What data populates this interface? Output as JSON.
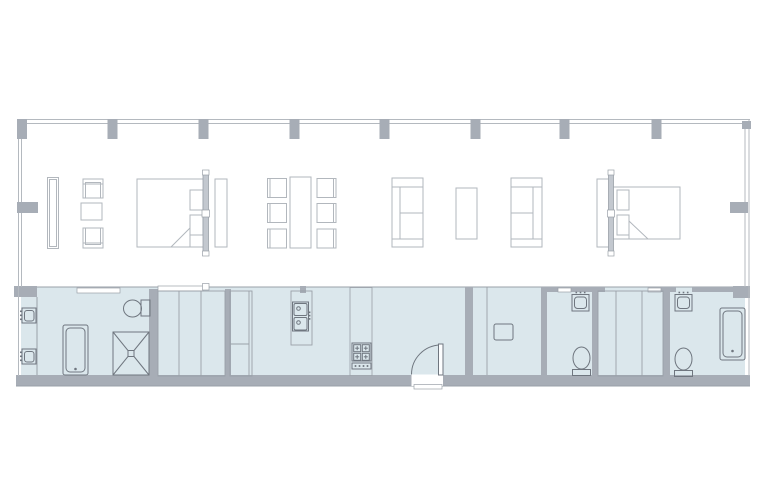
{
  "document": {
    "type": "architectural-floor-plan",
    "orientation": "landscape",
    "text_labels": []
  },
  "colors": {
    "background": "#ffffff",
    "wall_fill": "#a7adb6",
    "wall_line": "#9aa0a8",
    "outline_light": "#b4b9bf",
    "floor_fill": "#dbe7ec",
    "furniture_line": "#b2b7bd",
    "fixture_line": "#6f767f",
    "partition_fill": "#c3c8cf"
  },
  "inventory": {
    "structural_columns": 8,
    "wall_ticks": 4,
    "beds": 2,
    "bed_headboard_partitions": 2,
    "wardrobes": 2,
    "console_shelf": 1,
    "armchairs": 2,
    "side_tables": 3,
    "dining_tables": 1,
    "dining_chairs": 6,
    "sofas": 2,
    "coffee_tables": 1,
    "bathrooms": 3,
    "toilets": 3,
    "vanity_sinks": 4,
    "bathtubs": 2,
    "showers": 1,
    "closet_units": 3,
    "kitchen_sink_basins": 2,
    "cooktop_burners": 4,
    "washer_units": 1,
    "entry_doors": 1,
    "sliding_door_panels": 4
  }
}
